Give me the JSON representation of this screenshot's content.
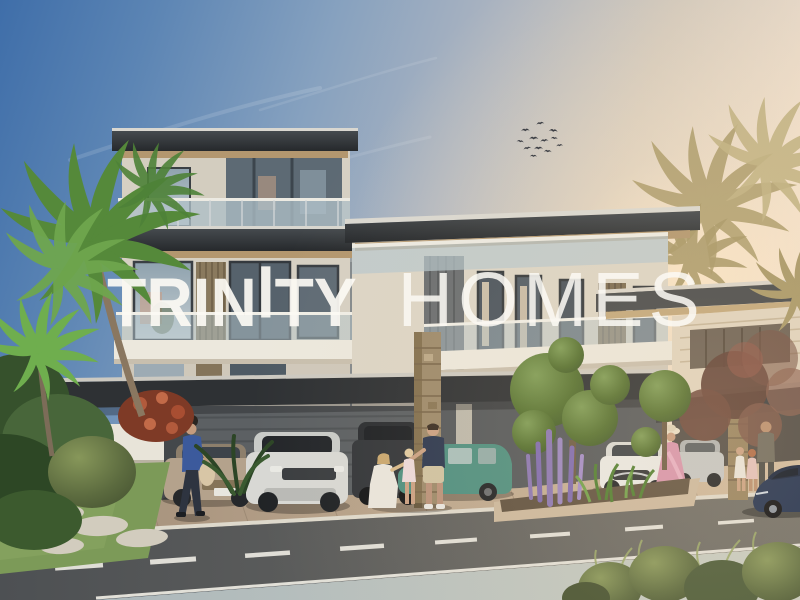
{
  "image": {
    "kind": "architectural-rendering",
    "description": "Sunset street view of a modern three-storey luxury townhouse with carports, parked cars, residents, palm trees and landscaped topiary; TRINITY HOMES watermark across the centre.",
    "width_px": 800,
    "height_px": 600
  },
  "watermark": {
    "part1": "TRIN",
    "accent_i": "I",
    "part2": "TY",
    "secondary": "HOMES",
    "color": "#faf8f2"
  },
  "sky": {
    "top_left": "#3f6ea9",
    "mid": "#aab3c0",
    "horizon_right": "#f4e6d4",
    "sun_glow": "#ffeacb",
    "birds_count": 12
  },
  "building": {
    "roof_fascia": "#31363b",
    "roof_top_edge": "#d9d7d0",
    "soffit_wood": "#b3976f",
    "wall_beige": "#d6d0c3",
    "glass": "#9aa8b2",
    "glass_dark": "#4a545e",
    "balcony_fascia": "#ece8dd",
    "stone_column": "#a08b6c",
    "carport_wall": "#5c6063",
    "louver_wood": "#8a7a5e"
  },
  "street": {
    "asphalt": "#55585b",
    "lane_marking": "#eceae2",
    "curb": "#ded9cc",
    "sidewalk": "#b9c2c4",
    "paver_driveway": "#bfa98f",
    "grass": "#7c9a58"
  },
  "vehicles": [
    {
      "label": "beige-sedan",
      "color": "#b4a28c"
    },
    {
      "label": "silver-land-rover-suv",
      "color": "#d8d8d4"
    },
    {
      "label": "dark-grey-suv",
      "color": "#33363a"
    },
    {
      "label": "teal-estate-car",
      "color": "#4e8f80"
    },
    {
      "label": "white-crossover",
      "color": "#e9e9e6"
    },
    {
      "label": "silver-sedan",
      "color": "#c3c6c6"
    },
    {
      "label": "navy-sports-car",
      "color": "#1f3050"
    }
  ],
  "people": [
    {
      "label": "woman-walking-with-bag",
      "outfit": "blue top, dark jeans, beige tote bag"
    },
    {
      "label": "man-standing-with-family",
      "outfit": "navy t-shirt, beige shorts"
    },
    {
      "label": "woman-kneeling",
      "outfit": "white dress"
    },
    {
      "label": "toddler-girl",
      "outfit": "pale pink dress"
    },
    {
      "label": "woman-in-pink-dress",
      "outfit": "pink flowing dress, sun hat"
    },
    {
      "label": "man-with-two-children",
      "outfit": "grey-olive shirt"
    }
  ],
  "vegetation": [
    {
      "label": "green-palm-trees-left"
    },
    {
      "label": "golden-backlit-palms-right"
    },
    {
      "label": "round-topiary-trees-centre"
    },
    {
      "label": "purple-flower-spikes"
    },
    {
      "label": "red-flowering-shrub-left"
    },
    {
      "label": "plum-foliage-tree-right"
    },
    {
      "label": "foreground-bushes-bottom-right"
    }
  ]
}
